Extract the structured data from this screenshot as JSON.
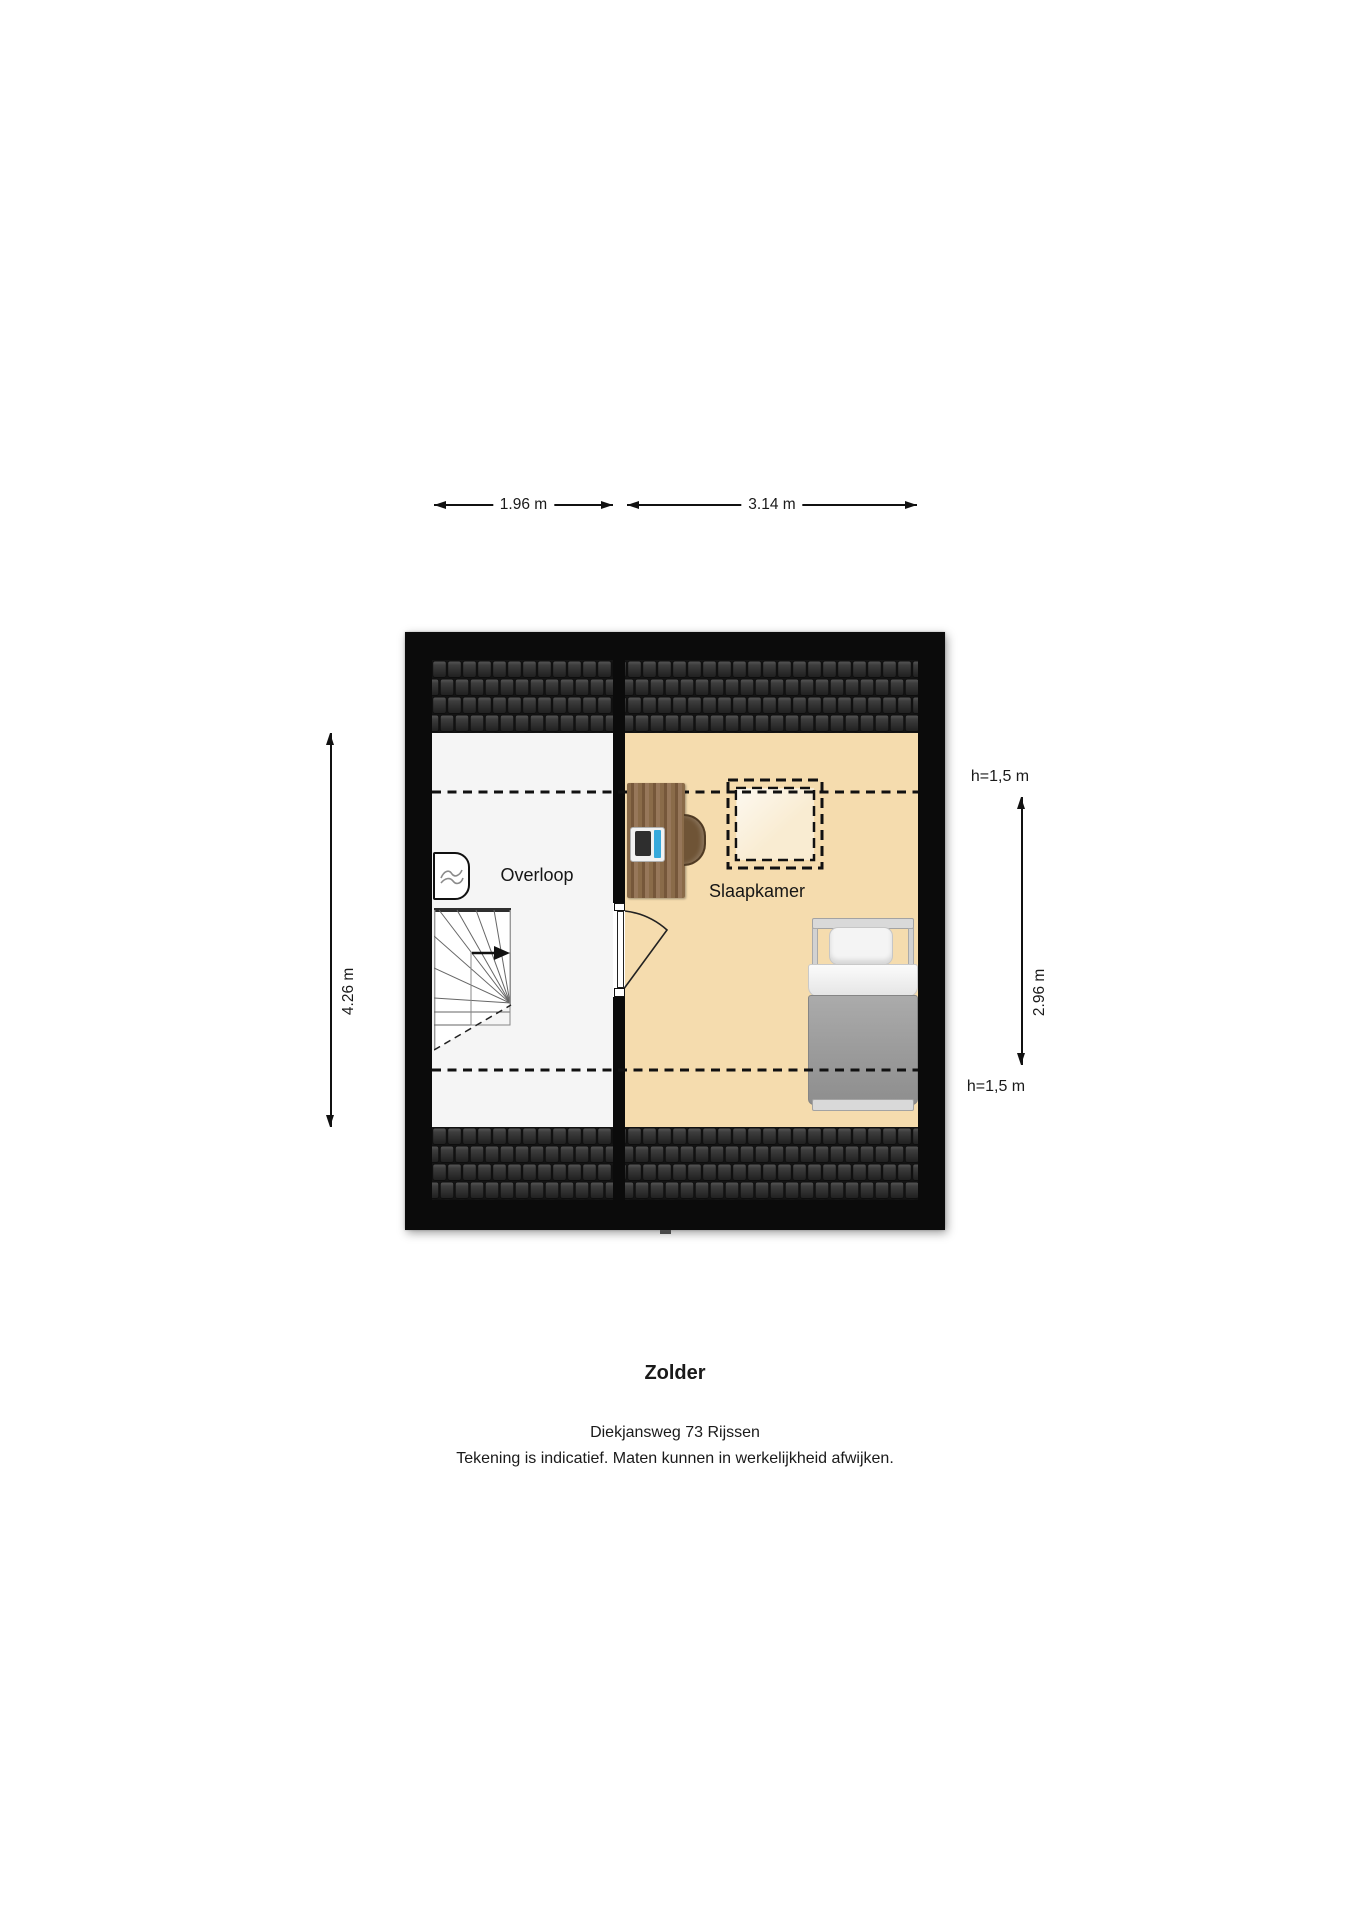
{
  "footer": {
    "title": "Zolder",
    "address": "Diekjansweg 73 Rijssen",
    "disclaimer": "Tekening is indicatief. Maten kunnen in werkelijkheid afwijken."
  },
  "rooms": {
    "overloop": {
      "label": "Overloop"
    },
    "slaapkamer": {
      "label": "Slaapkamer"
    }
  },
  "dimensions": {
    "top_overloop": "1.96 m",
    "top_slaapkamer": "3.14 m",
    "left_total": "4.26 m",
    "right_inner": "2.96 m",
    "headroom_top": "h=1,5 m",
    "headroom_bottom": "h=1,5 m"
  },
  "icons": {
    "ventilation": "ventilation-unit-icon",
    "stairs_arrow": "stairs-direction-arrow-icon",
    "door_swing": "door-swing-arc",
    "skylight": "skylight-dashed-outline"
  },
  "colors": {
    "wall": "#0b0b0b",
    "roof_tile_gap": "#141414",
    "floor_overloop": "#f5f5f5",
    "floor_slaapkamer": "#f5dcae",
    "skylight_fill": "#f9ecd2",
    "desk_wood": "#8a6b49",
    "desk_wood_dark": "#76573a",
    "chair_brown": "#6f5436",
    "laptop_screen": "#2e2e2e",
    "laptop_accent_blue": "#36a9dc",
    "bed_frame": "#d9d9d9",
    "bed_blanket": "#9d9d9d",
    "line": "#111111",
    "text": "#1a1a1a"
  }
}
